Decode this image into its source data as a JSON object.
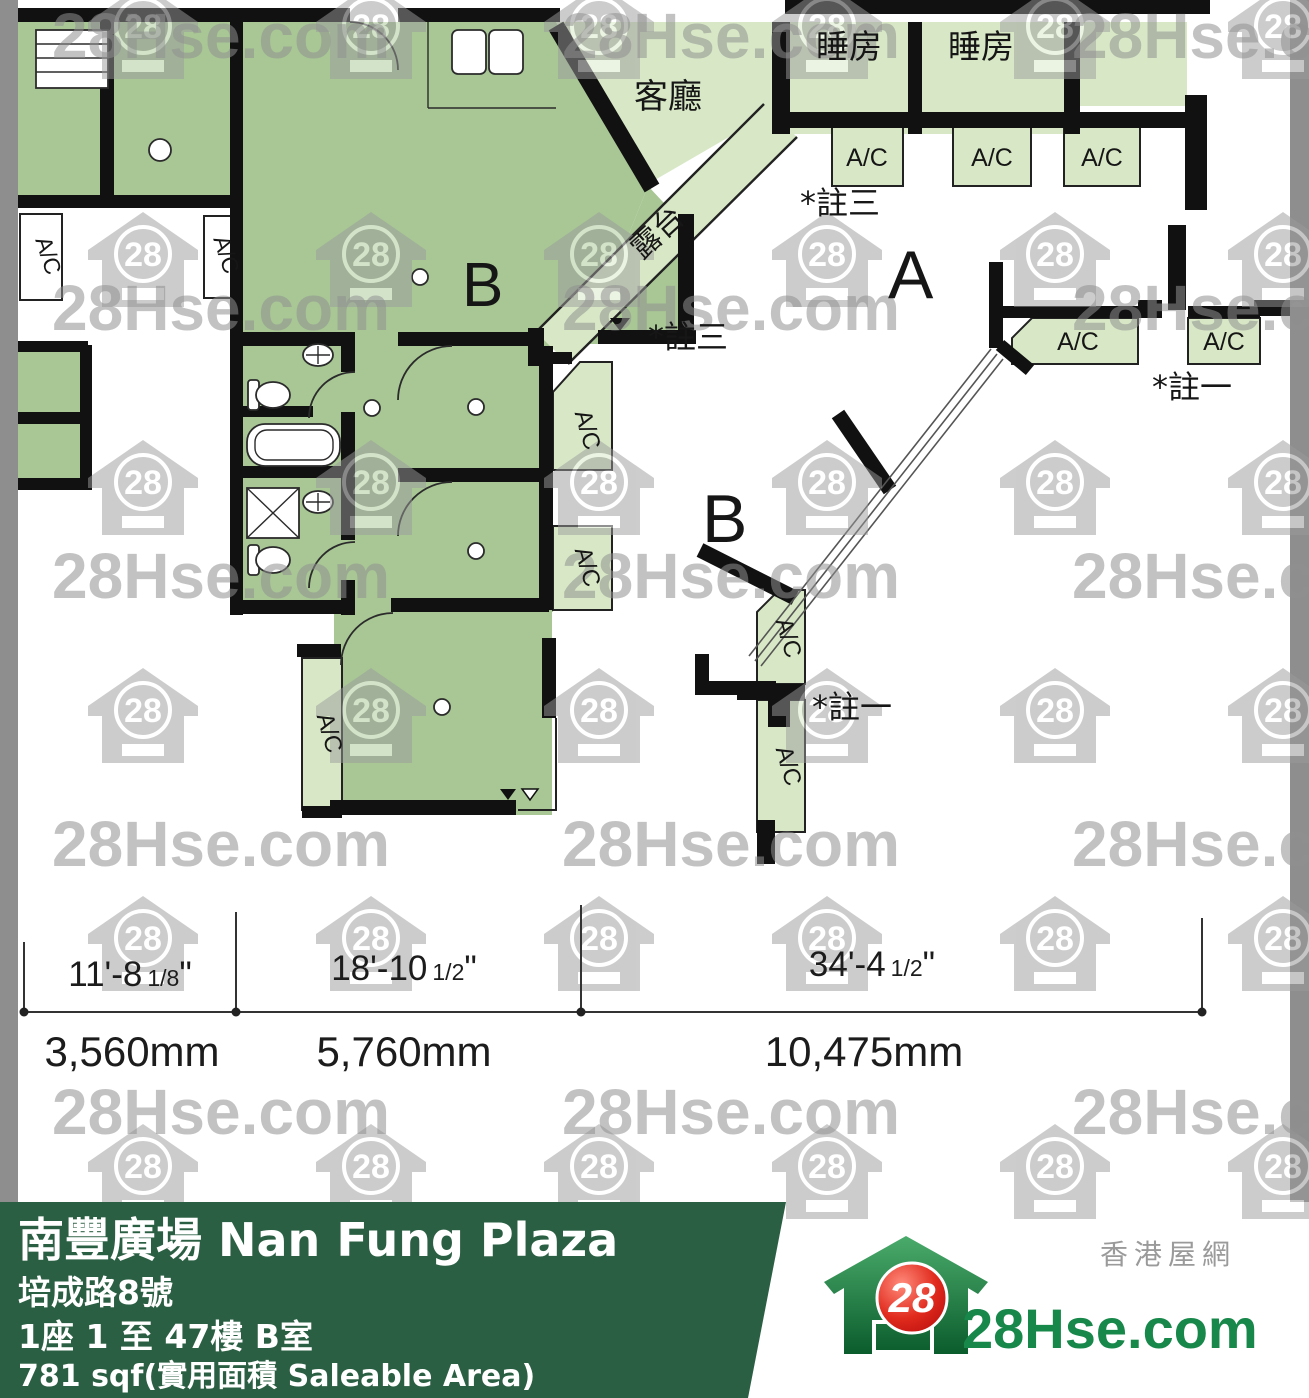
{
  "plan": {
    "living": "客廳",
    "balcony": "露台",
    "bedroom": "睡房",
    "ac": "A/C",
    "note3": "*註三",
    "note1": "*註一",
    "unit_a": "A",
    "unit_b": "B",
    "room_b": "B"
  },
  "dimensions": {
    "quote": "\"",
    "segments": [
      {
        "feet": "11'-8",
        "frac": "1/8",
        "mm": "3,560mm"
      },
      {
        "feet": "18'-10",
        "frac": "1/2",
        "mm": "5,760mm"
      },
      {
        "feet": "34'-4",
        "frac": "1/2",
        "mm": "10,475mm"
      }
    ]
  },
  "watermark": {
    "text": "28Hse.com",
    "badge": "28"
  },
  "footer": {
    "building": "南豐廣場 Nan Fung Plaza",
    "address": "培成路8號",
    "unit": "1座 1 至 47樓 B室",
    "area": "781 sqf(實用面積 Saleable Area)"
  },
  "logo": {
    "badge": "28",
    "site": "28Hse.com",
    "tagline": "香港屋網"
  },
  "colors": {
    "unit_fill": "#a8c795",
    "adjacent_fill": "#d8e8c6",
    "wall": "#111111",
    "footer_bg": "#2b5f43",
    "watermark_gray": "#8f8f8f",
    "border_gray": "#8e8e8e",
    "logo_red": "#d31616",
    "logo_green": "#17874a"
  }
}
